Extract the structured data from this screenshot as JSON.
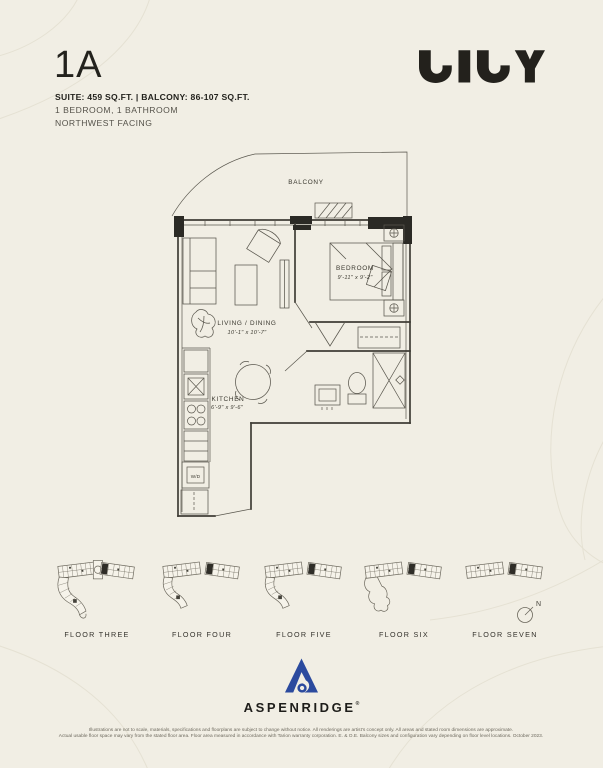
{
  "page": {
    "background_color": "#F1EEE4",
    "ink_color": "#23221d",
    "plan_line_color": "#5a574e",
    "aspenridge_blue": "#2B4A9E"
  },
  "header": {
    "unit_code": "1A",
    "stats_line": "SUITE: 459 SQ.FT.  |  BALCONY: 86-107 SQ.FT.",
    "rooms_line": "1 BEDROOM, 1 BATHROOM",
    "facing_line": "NORTHWEST FACING",
    "brand": "LILY"
  },
  "floorplan": {
    "labels": {
      "balcony": "BALCONY",
      "living": "LIVING / DINING",
      "living_dims": "10'-1\" x 10'-7\"",
      "bedroom": "BEDROOM",
      "bedroom_dims": "9'-11\" x 9'-2\"",
      "kitchen": "KITCHEN",
      "kitchen_dims": "6'-9\" x 9'-6\"",
      "washer_dryer": "W/D"
    }
  },
  "keyplans": {
    "floors": [
      {
        "label": "FLOOR THREE"
      },
      {
        "label": "FLOOR FOUR"
      },
      {
        "label": "FLOOR FIVE"
      },
      {
        "label": "FLOOR SIX"
      },
      {
        "label": "FLOOR SEVEN"
      }
    ],
    "north_label": "N"
  },
  "footer": {
    "brand": "ASPENRIDGE",
    "registered_mark": "®",
    "disclaimer_line1": "Illustrations are not to scale, materials, specifications and floorplans are subject to change without notice. All renderings are artist's concept only. All areas and stated room dimensions are approximate.",
    "disclaimer_line2": "Actual usable floor space may vary from the stated floor area. Floor area measured in accordance with Tarion warranty corporation. E. & O.E. Balcony sizes and configuration vary depending on floor level locations. October 2023."
  }
}
